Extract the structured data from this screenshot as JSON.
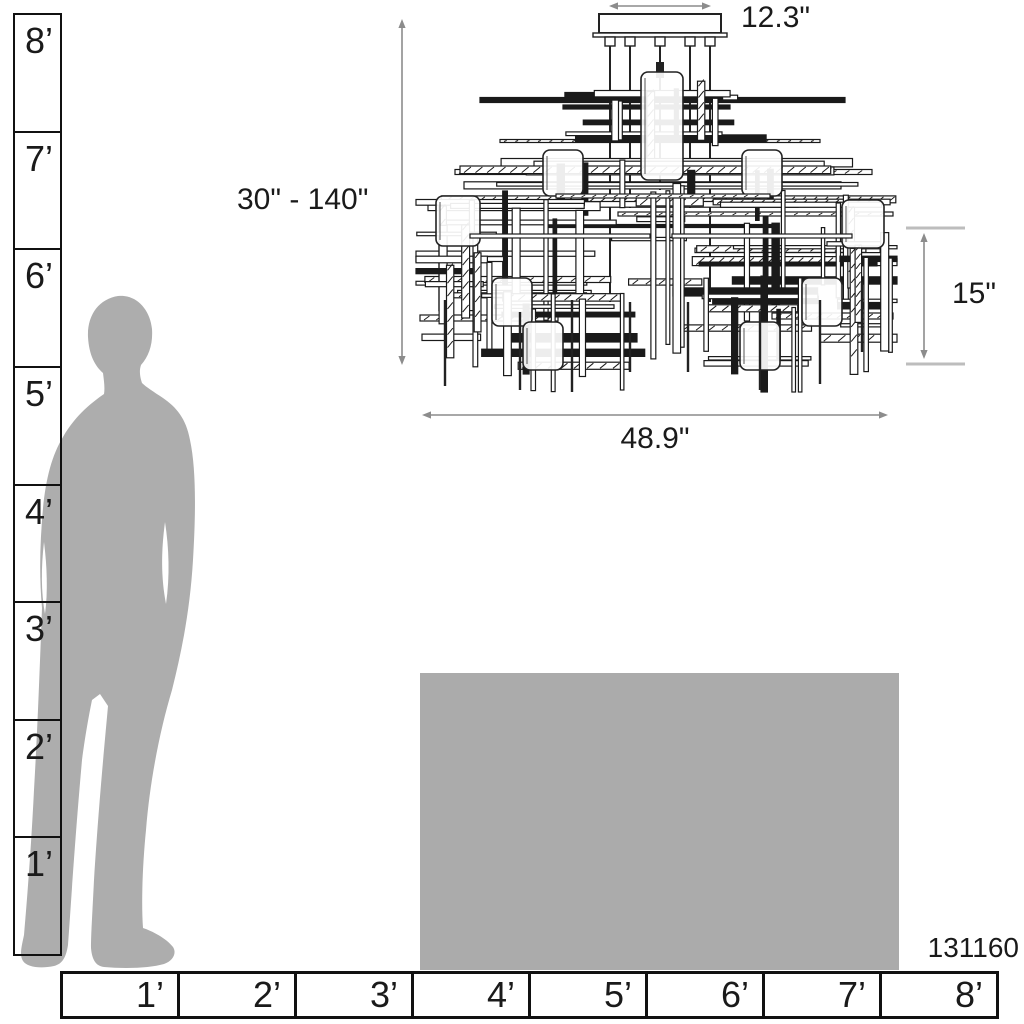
{
  "product": {
    "model_number": "131160",
    "type_label": "chandelier-scale-diagram"
  },
  "dimensions": {
    "canopy_width": "12.3\"",
    "hanging_height_range": "30\" - 140\"",
    "fixture_height": "15\"",
    "fixture_width": "48.9\""
  },
  "vertical_ruler": {
    "labels": [
      "8’",
      "7’",
      "6’",
      "5’",
      "4’",
      "3’",
      "2’",
      "1’"
    ]
  },
  "horizontal_ruler": {
    "labels": [
      "1’",
      "2’",
      "3’",
      "4’",
      "5’",
      "6’",
      "7’",
      "8’"
    ]
  },
  "colors": {
    "silhouette_gray": "#adadad",
    "table_gray": "#ababab",
    "dimension_line_gray": "#8c8c8c",
    "tick_gray": "#bdbdbd",
    "line_art": "#1a1a1a",
    "text": "#1a1a1a"
  }
}
